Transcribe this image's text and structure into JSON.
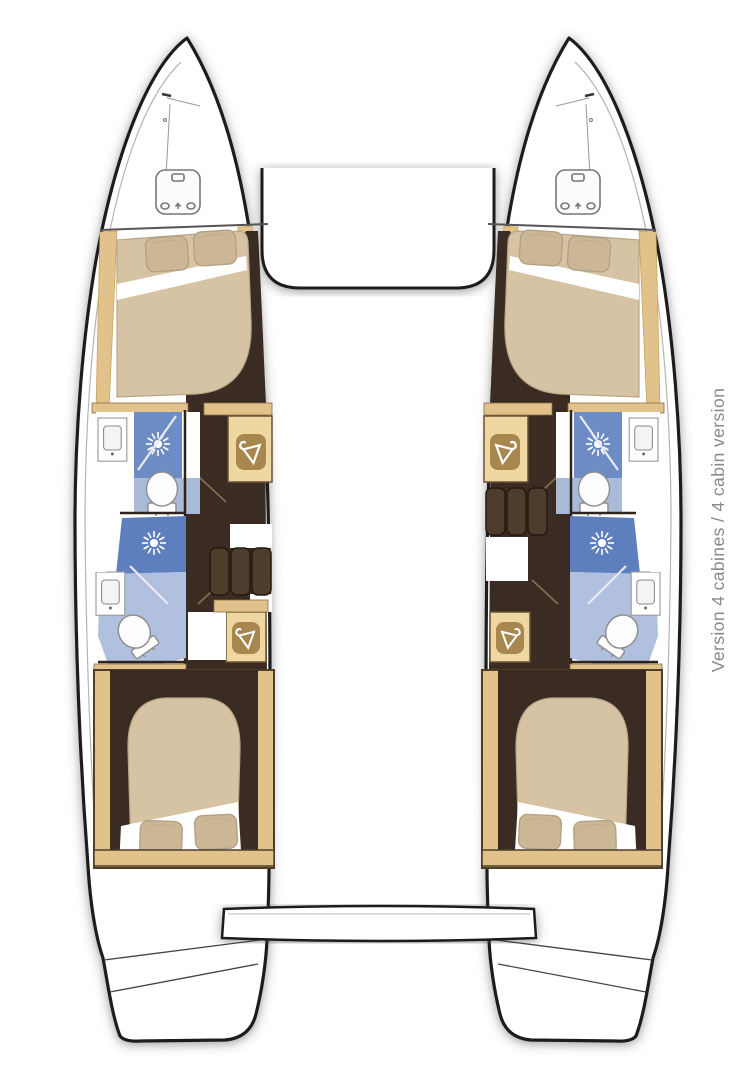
{
  "caption": {
    "text": "Version 4 cabines / 4 cabin version"
  },
  "plan": {
    "type": "catamaran floor plan (top view)",
    "version_label_fr": "Version 4 cabines",
    "version_label_en": "4 cabin version",
    "hulls": [
      {
        "id": "port",
        "features": [
          "bow deck hatch",
          "forward double bed with 2 pillows",
          "washbasin",
          "shower",
          "toilet",
          "wardrobe",
          "second shower",
          "second washbasin",
          "second toilet",
          "second wardrobe",
          "companionway steps",
          "aft double bed with 2 pillows",
          "transom swim steps"
        ]
      },
      {
        "id": "starboard",
        "features": [
          "bow deck hatch",
          "forward double bed with 2 pillows",
          "washbasin",
          "shower",
          "toilet",
          "wardrobe",
          "second shower",
          "second washbasin",
          "second toilet",
          "second wardrobe",
          "companionway steps",
          "aft double bed with 2 pillows",
          "transom swim steps"
        ]
      }
    ],
    "shared_elements": [
      "foredeck bridge between hulls",
      "aft platform step between hulls"
    ]
  },
  "palette": {
    "hull_outline": "#1b1b1b",
    "wood_trim": "#e2c28b",
    "wardrobe_inner": "#a8874f",
    "floor_dark_brown": "#3a2c22",
    "bathroom_light_blue": "#b0c0de",
    "shower_blue": "#6d8cc3",
    "shower_blue_dark": "#5d7fbe",
    "bed_tan": "#d6c3a3",
    "pillow_tan": "#cbb695",
    "caption_gray": "#8a8a8a"
  }
}
